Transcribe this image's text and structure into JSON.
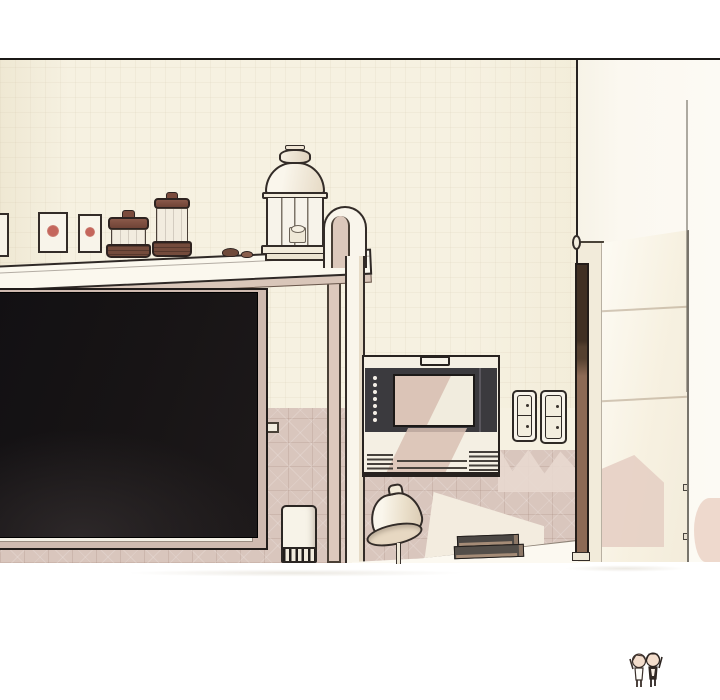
{
  "meta": {
    "type": "illustration-panel",
    "content": "interior scene: kitchen wall shelf with jars and lantern, large dark TV screen, wall-mounted monitor, light switches, open door with bar handle, desk lamp, stacked books, canister"
  },
  "palette": {
    "paper": "#ffffff",
    "outline": "#1b1917",
    "wall_cream": "#f6f1e1",
    "wall_white": "#fcfaf4",
    "wainscot_pink": "#d9c6bd",
    "shelf_underside": "#d9c6b9",
    "tv_frame": "#cfbab0",
    "screen_dark": "#151214",
    "device_body": "#f4efe3",
    "device_panel": "#3b3a3e",
    "device_screen": "#f1ecde",
    "shadow_pink": "#d8c0b3",
    "lid_brown": "#7b4b3c",
    "wood_dark": "#413023",
    "wood_red": "#8d6a55",
    "label_red": "#c4665c",
    "book_dark": "#4b4744",
    "book_pages": "#a58c77"
  },
  "objects": {
    "shelf_items": [
      "storage-box",
      "storage-box",
      "spice-jar-short",
      "spice-jar-tall",
      "pebbles",
      "candle-lantern"
    ],
    "wall_items": [
      "wall-shelf-arch-frame",
      "tv-screen",
      "wall-monitor",
      "light-switch-plate",
      "light-switch-plate"
    ],
    "floor_items": [
      "canister",
      "desk",
      "desk-lamp",
      "book-stack"
    ],
    "right_side": [
      "wall-corner",
      "door-frame",
      "door",
      "door-handle"
    ],
    "signature": "chibi-mascot-figures"
  }
}
